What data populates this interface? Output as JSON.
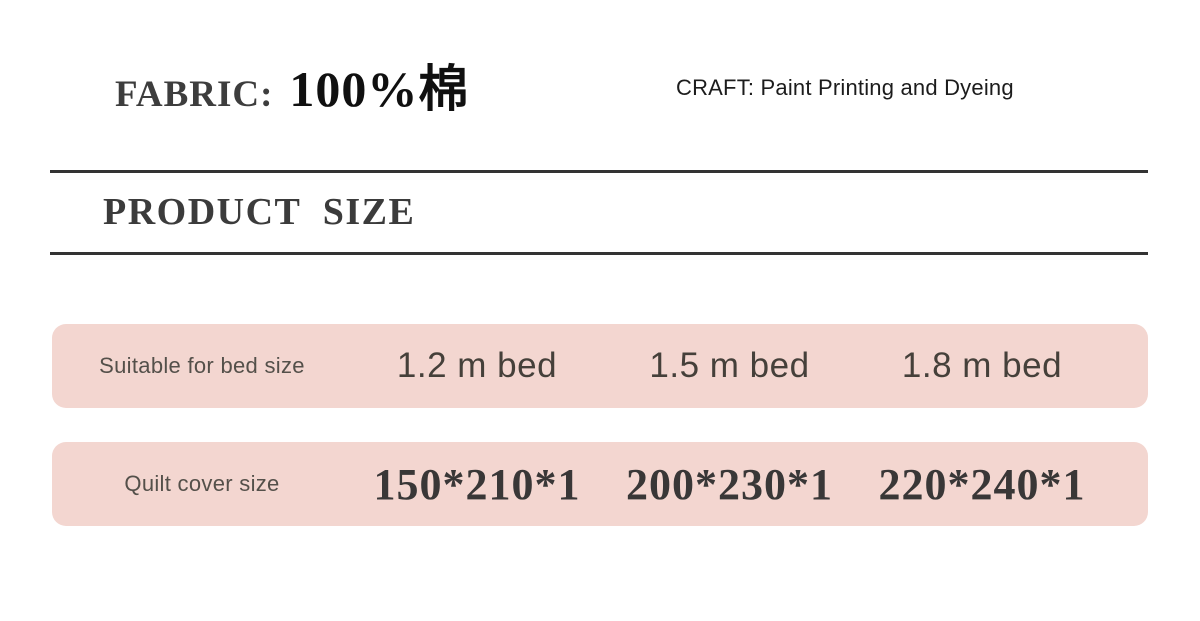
{
  "page": {
    "background": "#ffffff",
    "accent_pink": "#f3d6d0",
    "rule_color": "#333333"
  },
  "header": {
    "fabric_label": "FABRIC:",
    "fabric_value": "100%棉",
    "craft_text": "CRAFT: Paint Printing and Dyeing"
  },
  "section_title": "PRODUCT  SIZE",
  "size_table": {
    "rows": [
      {
        "label": "Suitable for bed size",
        "values": [
          "1.2 m bed",
          "1.5 m bed",
          "1.8 m bed"
        ]
      },
      {
        "label": "Quilt cover size",
        "values": [
          "150*210*1",
          "200*230*1",
          "220*240*1"
        ]
      }
    ]
  }
}
